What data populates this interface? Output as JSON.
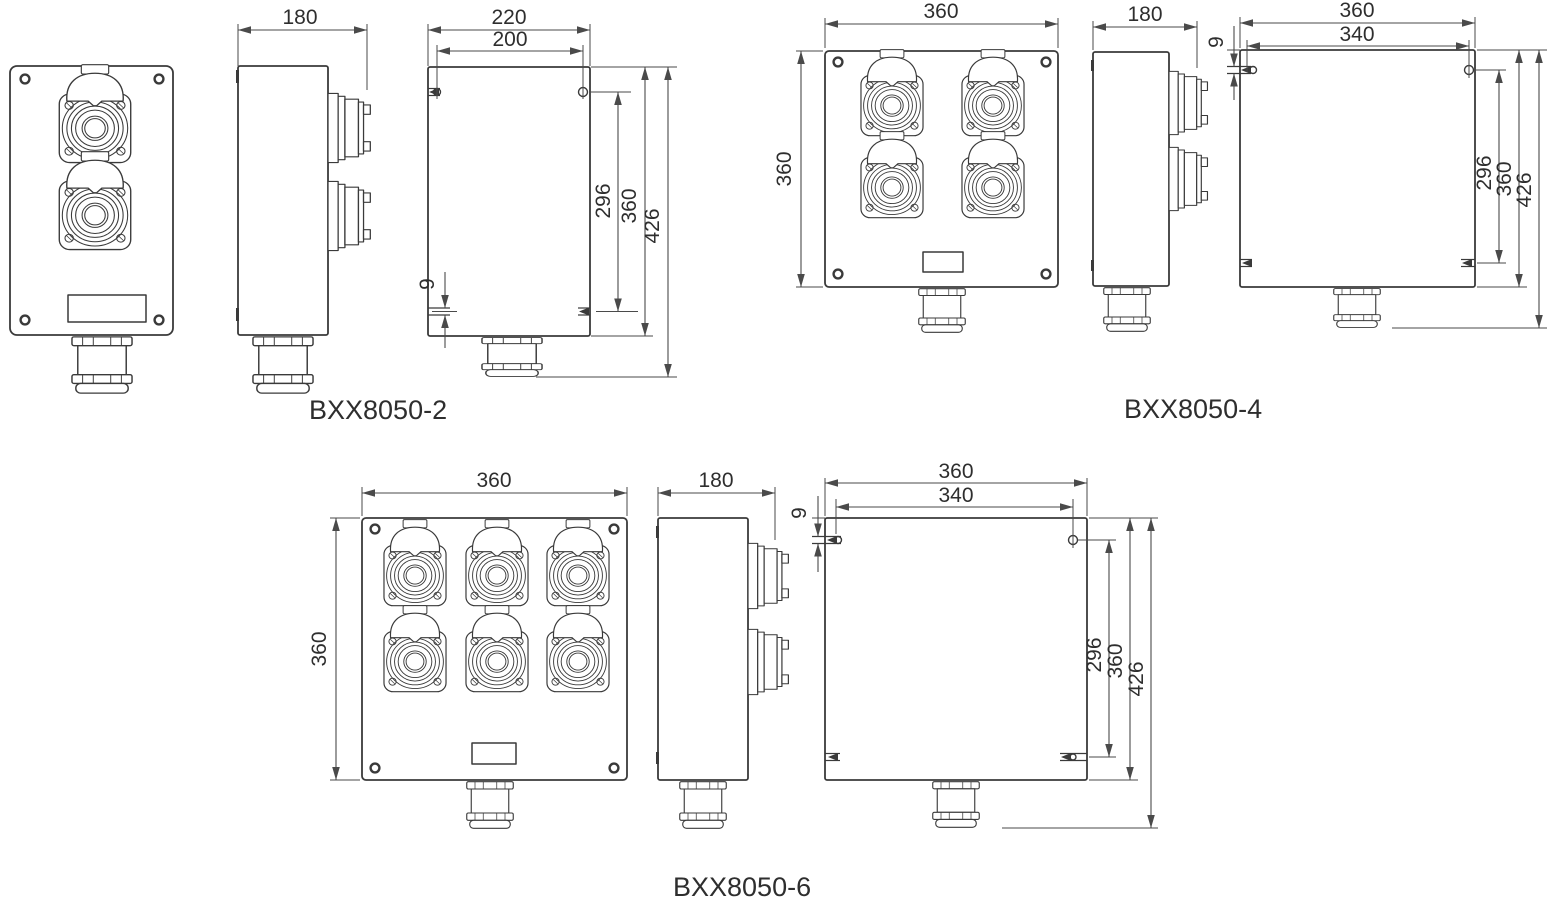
{
  "sheet": {
    "background_color": "#ffffff",
    "line_color": "#3a3a3a",
    "models": [
      {
        "name": "BXX8050-2",
        "socket_count": 2,
        "dims": {
          "depth": "180",
          "overall_width": "220",
          "hole_span_x": "200",
          "hole_span_y": "296",
          "body_height": "360",
          "overall_height": "426",
          "slot_width": "9"
        }
      },
      {
        "name": "BXX8050-4",
        "socket_count": 4,
        "dims": {
          "width": "360",
          "height": "360",
          "depth": "180",
          "overall_width": "360",
          "hole_span_x": "340",
          "hole_span_y": "296",
          "body_height": "360",
          "overall_height": "426",
          "slot_width": "9"
        }
      },
      {
        "name": "BXX8050-6",
        "socket_count": 6,
        "dims": {
          "width": "360",
          "height": "360",
          "depth": "180",
          "overall_width": "360",
          "hole_span_x": "340",
          "hole_span_y": "296",
          "body_height": "360",
          "overall_height": "426",
          "slot_width": "9"
        }
      }
    ]
  }
}
